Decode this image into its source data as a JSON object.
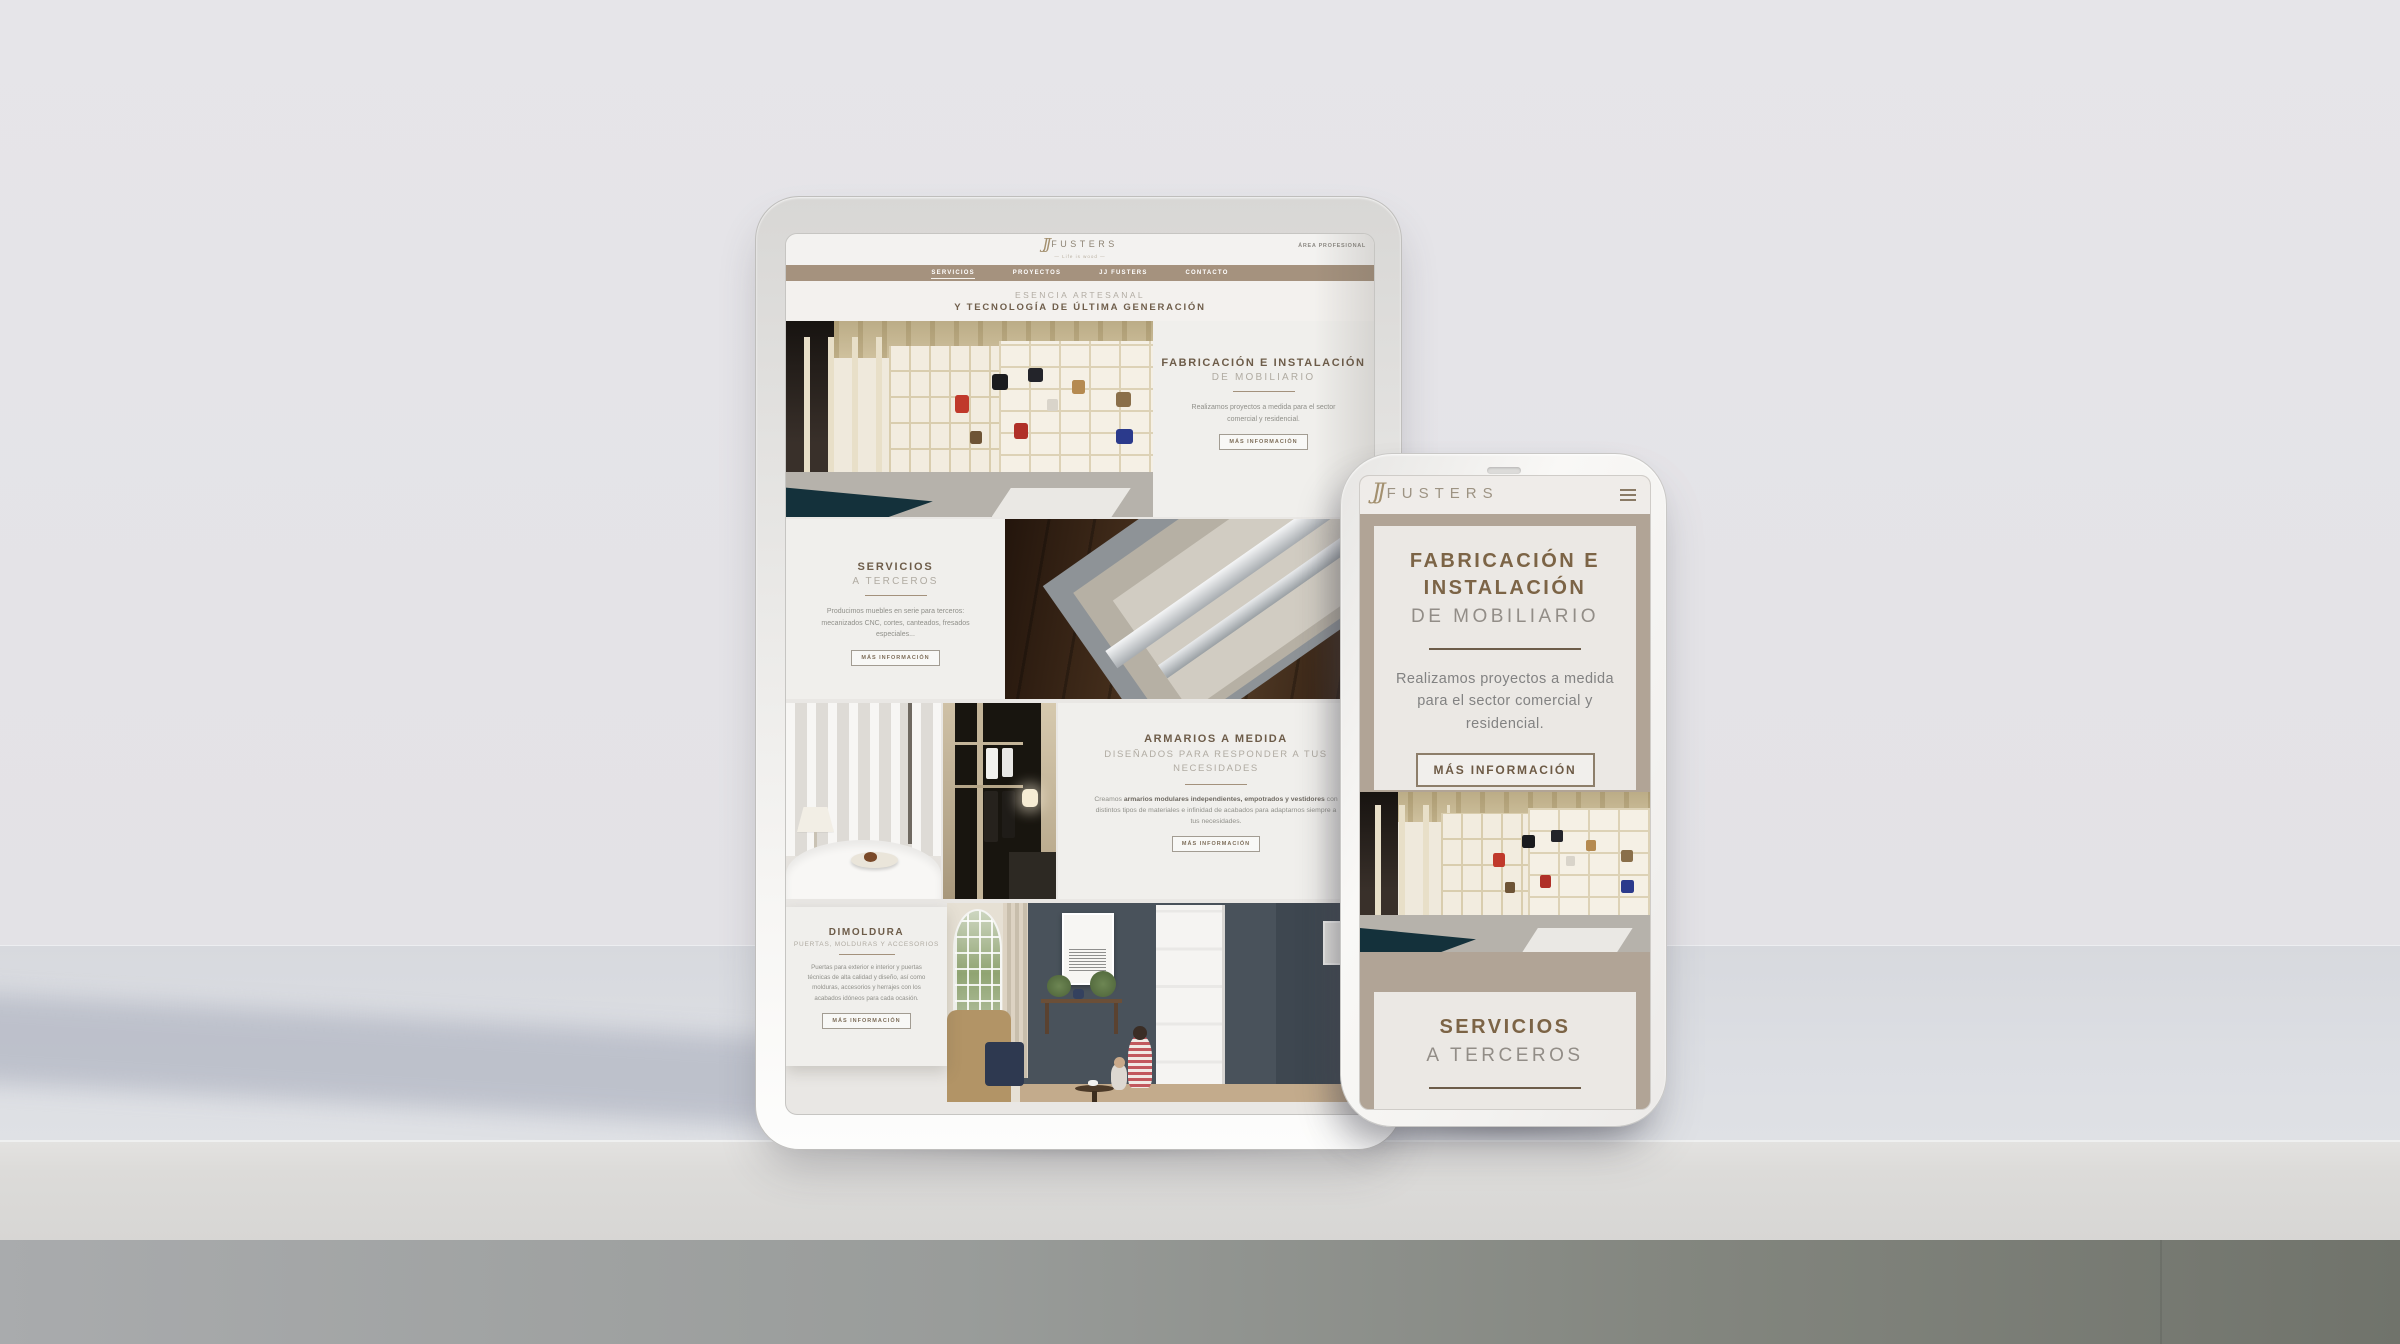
{
  "palette": {
    "nav_bar": "#a5927e",
    "phone_background": "#b1a496",
    "heading_brown": "#6f5c46",
    "body_text_gray": "#8c8c88",
    "page_background": "#e9e7e4"
  },
  "tablet": {
    "logo": {
      "monogram": "JJ",
      "name": "FUSTERS",
      "tagline": "— Life is wood —"
    },
    "area_link": "ÁREA PROFESIONAL",
    "nav": [
      {
        "label": "SERVICIOS",
        "active": true
      },
      {
        "label": "PROYECTOS",
        "active": false
      },
      {
        "label": "JJ FUSTERS",
        "active": false
      },
      {
        "label": "CONTACTO",
        "active": false
      }
    ],
    "hero": {
      "line1": "ESENCIA ARTESANAL",
      "line2": "Y TECNOLOGÍA DE ÚLTIMA GENERACIÓN"
    },
    "sections": [
      {
        "title": "FABRICACIÓN E INSTALACIÓN",
        "subtitle": "DE MOBILIARIO",
        "body": "Realizamos proyectos a medida para el sector comercial y residencial.",
        "button": "MÁS INFORMACIÓN",
        "image": "handbag-showroom-shelving"
      },
      {
        "title": "SERVICIOS",
        "subtitle": "A TERCEROS",
        "body": "Producimos muebles en serie para terceros: mecanizados CNC, cortes, canteados, fresados especiales...",
        "button": "MÁS INFORMACIÓN",
        "image": "drawer-panels-on-wood-floor"
      },
      {
        "title": "ARMARIOS A MEDIDA",
        "subtitle": "DISEÑADOS PARA RESPONDER A TUS NECESIDADES",
        "body_prefix": "Creamos ",
        "body_bold": "armarios modulares independientes, empotrados y vestidores",
        "body_suffix": " con distintos tipos de materiales e infinidad de acabados para adaptarnos siempre a tus necesidades.",
        "button": "MÁS INFORMACIÓN",
        "images": [
          "bedroom-curtains",
          "dark-closet-interior"
        ]
      },
      {
        "title": "DIMOLDURA",
        "subtitle": "PUERTAS, MOLDURAS Y ACCESORIOS",
        "body": "Puertas para exterior e interior y puertas técnicas de alta calidad y diseño, así como molduras, accesorios y herrajes con los acabados idóneos para cada ocasión.",
        "button": "MÁS INFORMACIÓN",
        "image": "living-room-white-door"
      }
    ]
  },
  "phone": {
    "logo": {
      "monogram": "JJ",
      "name": "FUSTERS"
    },
    "card1": {
      "title": "FABRICACIÓN E INSTALACIÓN",
      "subtitle": "DE MOBILIARIO",
      "body": "Realizamos proyectos a medida para el sector comercial y residencial.",
      "button": "MÁS INFORMACIÓN"
    },
    "photo": "handbag-showroom-shelving",
    "card2": {
      "title": "SERVICIOS",
      "subtitle": "A TERCEROS",
      "body": "Producimos muebles en serie"
    }
  }
}
